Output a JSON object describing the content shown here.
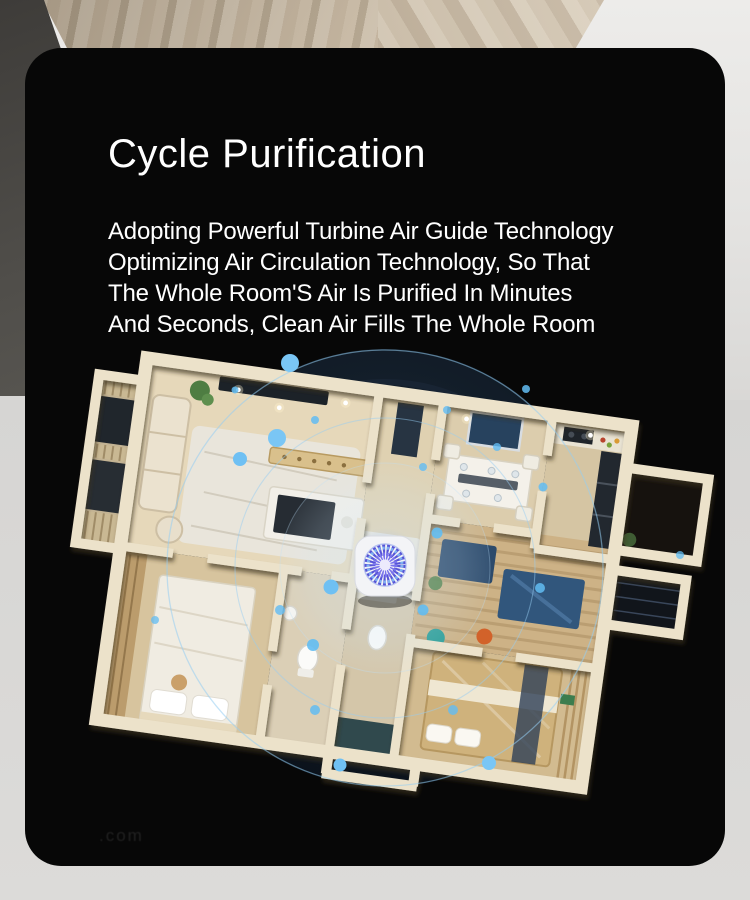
{
  "header": {
    "title": "Cycle Purification"
  },
  "description": {
    "lines": [
      "Adopting Powerful Turbine Air Guide Technology",
      "Optimizing Air Circulation Technology, So That",
      "The Whole Room'S Air Is Purified In Minutes",
      "And Seconds, Clean Air Fills The Whole Room"
    ]
  },
  "scene": {
    "watermark": ".com",
    "colors": {
      "page_background": "#d7d6d4",
      "card_background": "#070707",
      "text_white": "#ffffff",
      "accent_particle_blue": "#62bcf2",
      "device_turbine_blue": "#4a45d2",
      "apartment_wall_cream": "#ece2ca",
      "ripple_ring_blue": "#96cdf3"
    }
  }
}
